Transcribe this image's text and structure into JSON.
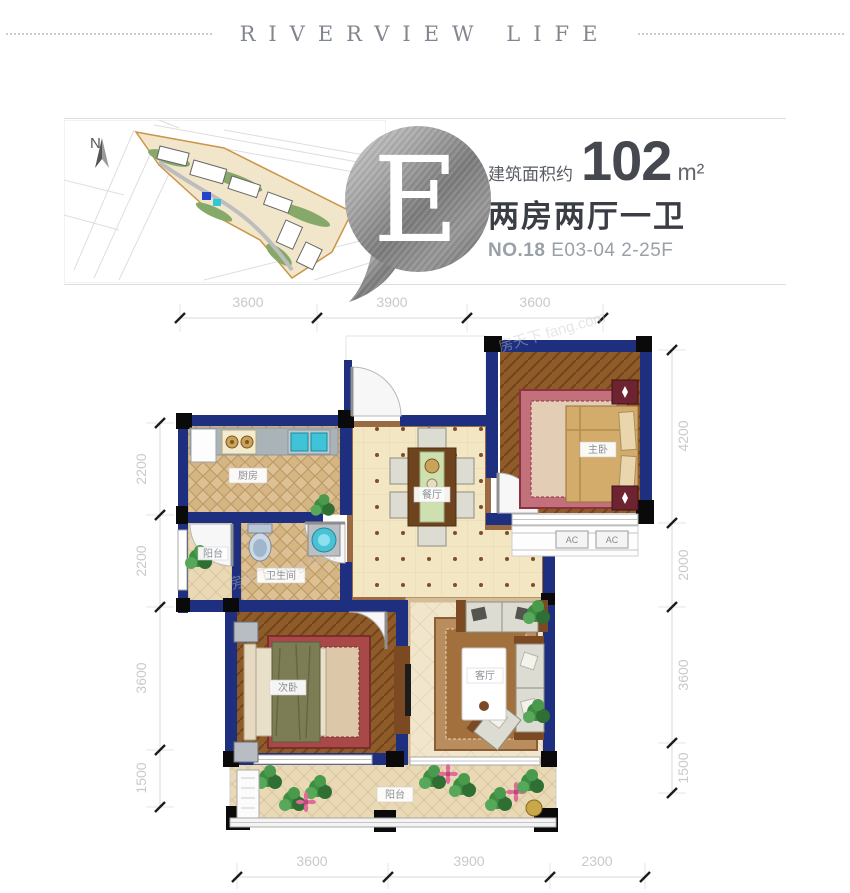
{
  "header": {
    "title": "RIVERVIEW LIFE"
  },
  "banner": {
    "badge_letter": "E",
    "compass_label": "N",
    "area_label": "建筑面积约",
    "area_value": "102",
    "area_unit": "m²",
    "layout_text": "两房两厅一卫",
    "unit_prefix": "NO.18",
    "unit_detail": "E03-04 2-25F"
  },
  "floorplan": {
    "rooms": {
      "kitchen": "厨房",
      "bathroom": "卫生间",
      "dining": "餐厅",
      "living": "客厅",
      "master_bedroom": "主卧",
      "second_bedroom": "次卧",
      "balcony": "阳台",
      "service_balcony": "阳台"
    },
    "ac_label_1": "AC",
    "ac_label_2": "AC",
    "dimensions": {
      "top": [
        "3600",
        "3900",
        "3600"
      ],
      "bottom": [
        "3600",
        "3900",
        "2300"
      ],
      "left": [
        "2200",
        "2200",
        "3600",
        "1500"
      ],
      "right": [
        "4200",
        "2000",
        "3600",
        "1500"
      ]
    },
    "watermark": "房天下 fang.com",
    "colors": {
      "wall_navy": "#1d2f7e",
      "tile_tan": "#d9bd8e",
      "tile_cream": "#f3e6c2",
      "wood": "#8f5b28"
    }
  }
}
